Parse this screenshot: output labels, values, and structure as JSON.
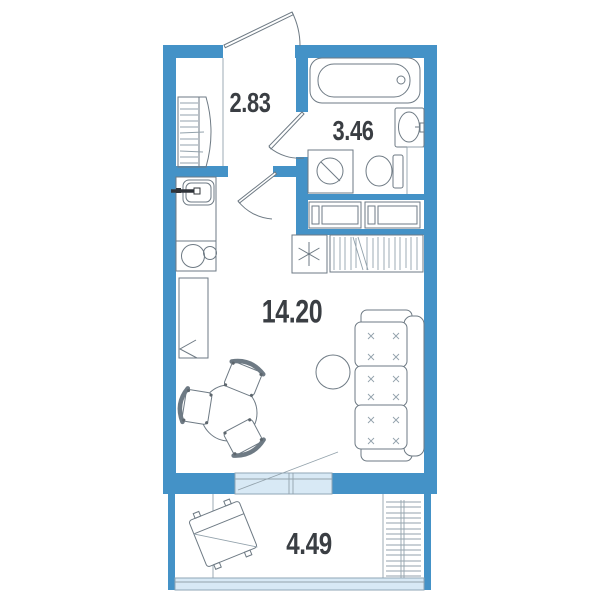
{
  "rooms": [
    {
      "name": "hallway",
      "area": "2.83"
    },
    {
      "name": "bathroom",
      "area": "3.46"
    },
    {
      "name": "living-room",
      "area": "14.20"
    },
    {
      "name": "balcony",
      "area": "4.49"
    }
  ],
  "colors": {
    "wall": "#4492c7",
    "glazing_fill": "#d8e9f5",
    "outline": "#6e7a84",
    "label_text": "#3a3e43",
    "background": "#ffffff"
  },
  "symbols": [
    "entrance-door",
    "hallway-closet",
    "kitchen-sink",
    "kitchen-stove",
    "kitchen-cabinet",
    "bathroom-door",
    "bathtub",
    "washbasin",
    "toilet",
    "washing-machine",
    "built-in-closet",
    "refrigerator",
    "wardrobe",
    "room-door",
    "dining-table",
    "dining-chair",
    "pouf",
    "sofa",
    "balcony-window",
    "balcony-door-swing",
    "balcony-chair",
    "drying-rack",
    "balcony-glazing"
  ]
}
